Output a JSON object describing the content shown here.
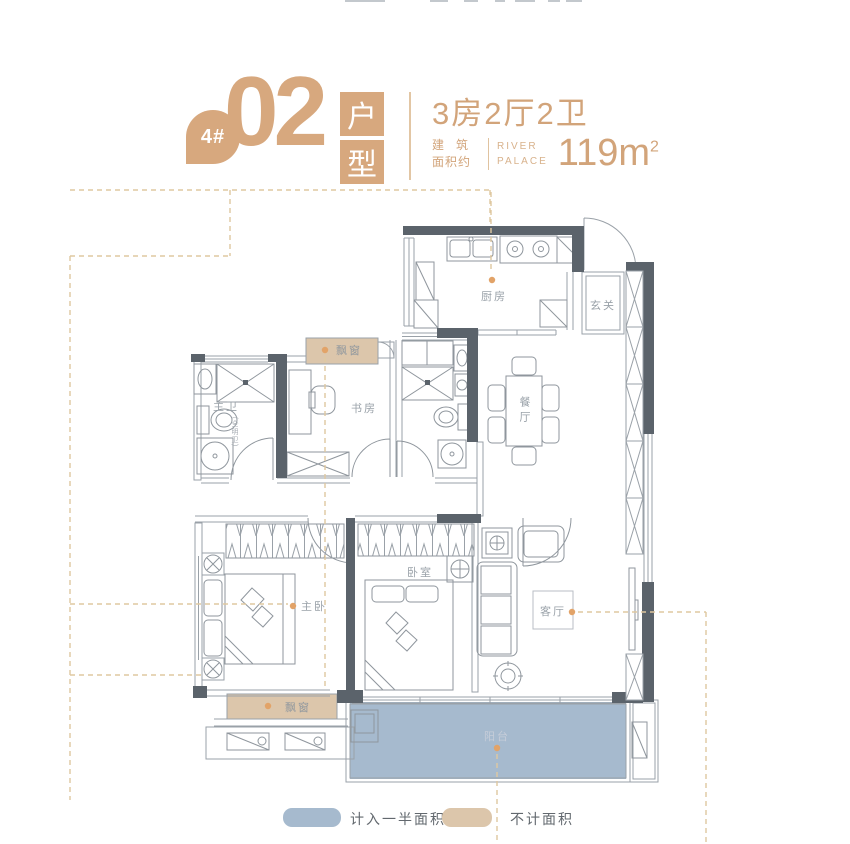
{
  "header": {
    "building_badge": "4#",
    "unit_number": "02",
    "unit_type_chars": [
      "户",
      "型"
    ],
    "rooms_summary": "3房2厅2卫",
    "area_prefix_line1": "建筑",
    "area_prefix_line2": "面积约",
    "brand_line1": "RIVER",
    "brand_line2": "PALACE",
    "area_value": "119m",
    "area_exponent": "2"
  },
  "plan": {
    "labels": {
      "kitchen": "厨房",
      "foyer": "玄关",
      "bay_window_top": "飘窗",
      "master_bath": "主卫",
      "master_bath_note": "(全明卫)",
      "study": "书房",
      "dining": "餐厅",
      "master_bedroom": "主卧",
      "bedroom": "卧室",
      "living": "客厅",
      "bay_window_bottom": "飘窗",
      "balcony": "阳台"
    }
  },
  "legend": {
    "items": [
      {
        "label": "计入一半面积",
        "color": "#a6bace"
      },
      {
        "label": "不计面积",
        "color": "#dcc6ab"
      }
    ]
  },
  "colors": {
    "accent_tan": "#d7a87e",
    "marker_dot": "#e2a368",
    "wall_dark": "#5b636b",
    "balcony_blue": "#a6bace",
    "bay_window_tan": "#dcc6ab",
    "boundary_dash": "#dfc8a0"
  }
}
